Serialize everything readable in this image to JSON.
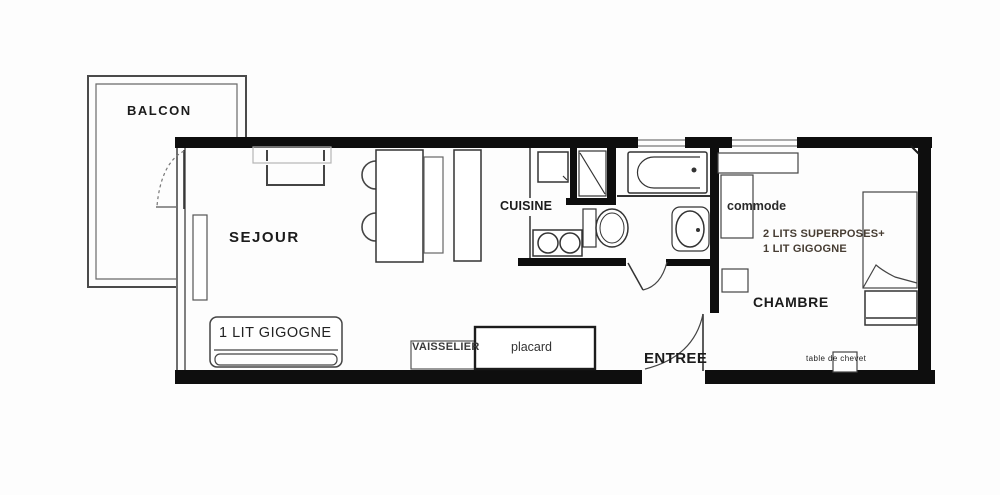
{
  "rooms": {
    "balcon": "BALCON",
    "sejour": "SEJOUR",
    "cuisine": "CUISINE",
    "chambre": "CHAMBRE",
    "entree": "ENTREE"
  },
  "furniture": {
    "sofa_bed_sejour": "1 LIT GIGOGNE",
    "vaisselier": "VAISSELIER",
    "placard": "placard",
    "commode": "commode",
    "chambre_note_line1": "2 LITS SUPERPOSES+",
    "chambre_note_line2": "1 LIT GIGOGNE",
    "nightstand": "table de chevet"
  },
  "colors": {
    "wall": "#0e0e0e",
    "line": "#3c3c3c",
    "background": "#fdfdfd"
  }
}
